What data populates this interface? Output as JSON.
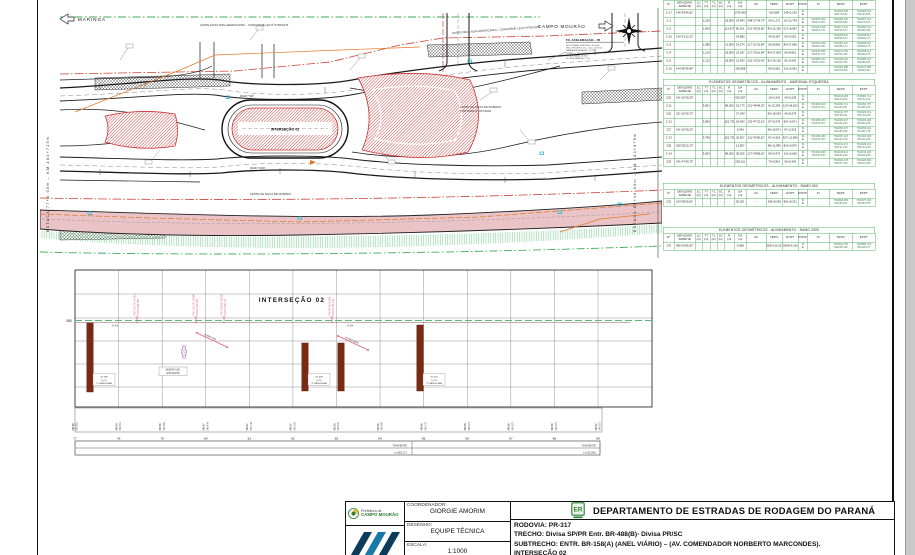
{
  "plan": {
    "dir_left": "MARINGÁ",
    "dir_right": "CAMPO MOURÃO",
    "intersection": "INTERSEÇÃO 02",
    "ramo_500": "RAMO \"500\"",
    "ramo_2000": "RAMO \"2000\"",
    "limite_nonaedificandi": "LIMITE FAIXA NON-AEDIFICANDI  –  CONFORME LEI Nº 6766/1979",
    "limite_dominio_1": "LIMITE DE FAIXA DE DOMÍNIO",
    "limite_dominio_2": "PORTARIA Nº 057/2018",
    "estaca_left": "ESTACA 77+0,00m   –   KM 183+725m",
    "estaca_right": "ESTACA 89+10,00m   –   KM 183+975m",
    "accel_title": "FX. ACELERAÇÃO – 05",
    "accel_lines": [
      "VELOCIDADE DIRETRIZ = 40 Km/h",
      "VEÍC. PROJETO: CO – Vop = 60 Km/h",
      "RAMPA ACELERAÇÃO = 0,75%",
      "COMPR. = 70 m  •  TAPER = 50 m",
      "FX. ADOTADA = 3,60 m",
      "FX. SEGURANÇA = 75 m"
    ]
  },
  "profile": {
    "title": "INTERSEÇÃO 02",
    "axis_elevation": "550",
    "stations": [
      "77",
      "78",
      "79",
      "80",
      "81",
      "82",
      "83",
      "84",
      "85",
      "86",
      "87",
      "88",
      "89"
    ],
    "elevations_design": [
      "549,88",
      "549,90",
      "549,86",
      "549,87",
      "549,87",
      "549,87",
      "549,85",
      "549,86",
      "549,86",
      "549,86",
      "549,86",
      "549,86",
      "549,87"
    ],
    "elevations_ground": [
      "549,851",
      "549,851",
      "549,869",
      "549,434",
      "549,144",
      "549,162",
      "549,320",
      "549,843",
      "549,770",
      "549,873",
      "549,872",
      "549,873",
      "549,872"
    ],
    "tangents": [
      {
        "t": "TANGENTE",
        "l": "L=158,171"
      },
      {
        "t": "TANGENTE",
        "l": "L=132,891"
      }
    ],
    "piv_labels": [
      {
        "a": "PIV=151.77+14,091",
        "b": "COTA=564,989"
      },
      {
        "a": "PIV=101.79+18,988",
        "b": "COTA=549,374"
      },
      {
        "a": "PIV=107.80+18,998",
        "b": "COTA=549,124"
      },
      {
        "a": "PIV=87.82+8,000",
        "b": "COTA=549,218"
      }
    ],
    "ramps": [
      "RAMO 500",
      "RAMO 2000"
    ],
    "markers": [
      "S–03",
      "S–04"
    ],
    "culvert": [
      "BUEIRO AÇO",
      "EXISTENTE"
    ],
    "boreholes": [
      {
        "label": "ST 008",
        "l": "L=1-0",
        "cat": "1ª CATEGORIA"
      },
      {
        "label": "ST 009",
        "l": "L=7-5",
        "cat": "1ª CATEGORIA"
      },
      {
        "label": "",
        "l": "",
        "cat": ""
      },
      {
        "label": "ST 010",
        "l": "L=7-5",
        "cat": "1ª CATEGORIA"
      }
    ]
  },
  "tables": {
    "columns": [
      "Nº",
      "DEFLEXÃO\nAZIMUTE",
      "LC\n(m)",
      "TT\n(m)",
      "TL\n(m)",
      "SC\n(m)",
      "R\n(m)",
      "DA\n(m)",
      "AC",
      "TE/PC",
      "ET/PT",
      "PONTO",
      "PI",
      "TE/PC",
      "ET/PT"
    ],
    "list": [
      {
        "title": "",
        "rows": [
          [
            "C-17",
            "146°53'46,61\"",
            "-",
            "-",
            "-",
            "-",
            "-",
            "1725,453",
            "-",
            "013,086",
            "140+1,253",
            "N\nE",
            "-",
            "7364094,483\n360176,824",
            "7364084,463\n360123,838"
          ],
          [
            "C-1",
            "-",
            "-",
            "1,225",
            "-",
            "-",
            "18,000",
            "24,694",
            "248°27'34,74\"",
            "09+1,272",
            "10+12,745",
            "N\nE",
            "7364045,809\n360321,955",
            "7364056,940\n360305,838",
            "7364057,101\n360276,815"
          ],
          [
            "C-2",
            "-",
            "-",
            "1,600",
            "-",
            "-",
            "113,675",
            "85,201",
            "212°36'18,80\"",
            "80+12,195",
            "017+8,587",
            "N\nE",
            "7364113,048\n360313,745",
            "7364117,341\n360310,572",
            "7364093,441\n360325,494"
          ],
          [
            "C-16",
            "140°13'12,23\"",
            "-",
            "-",
            "-",
            "-",
            "-",
            "24,880",
            "-",
            "43+8,287",
            "03+3,052",
            "N\nE",
            "-",
            "7364058,813\n360508,210",
            "7364058,901\n360508,273"
          ],
          [
            "C-3",
            "-",
            "-",
            "1,588",
            "-",
            "-",
            "13,000",
            "24,274",
            "217°21'26,84\"",
            "05+8,892",
            "84+17,895",
            "N\nE",
            "7364044,209\n360482,280",
            "7364054,407\n360488,272",
            "7364068,401\n360508,276"
          ],
          [
            "C-4",
            "-",
            "-",
            "1,116",
            "-",
            "-",
            "18,000",
            "23,187",
            "217°20'16,84\"",
            "84+17,803",
            "09+8,851",
            "N\nE",
            "7364046,868\n360336,778",
            "7364071,053\n360325,446",
            "7364055,413\n360308,278"
          ],
          [
            "C-5",
            "-",
            "-",
            "1,212",
            "-",
            "-",
            "18,000",
            "23,500",
            "215°10'22,40\"",
            "82+10,120",
            "91+3,642",
            "N\nE",
            "7364083,220\n360411,520",
            "7364090,118\n360402,335",
            "7364088,410\n360388,264"
          ],
          [
            "C-15",
            "144°50'36,84\"",
            "-",
            "-",
            "-",
            "-",
            "-",
            "190,088",
            "-",
            "80+5,851",
            "101+0,081",
            "N\nE",
            "-",
            "7364092,898\n360343,208",
            "7364101,988\n360308,403"
          ]
        ]
      },
      {
        "title": "ELEMENTOS GEOMÉTRICOS - ALINHAMENTO - MARGINAL ESQUERDA",
        "rows": [
          [
            "225",
            "241°18'18,33\"",
            "-",
            "-",
            "-",
            "-",
            "-",
            "602,287",
            "-",
            "10+1,941",
            "40+0,228",
            "N\nE",
            "-",
            "7364010,388\n360104,890",
            "7363982,714\n360700,202"
          ],
          [
            "C-11",
            "-",
            "-",
            "5,851",
            "-",
            "-",
            "88,000",
            "18,770",
            "212°48'48,32\"",
            "8+13,258",
            "120+18,812",
            "N\nE",
            "7364063,818\n361063,701",
            "7364064,714\n361064,787",
            "7364054,787\n361068,245"
          ],
          [
            "226",
            "221°18'18,72\"",
            "-",
            "-",
            "-",
            "-",
            "-",
            "27,043",
            "-",
            "83+18,034",
            "40+8,278",
            "N\nE",
            "-",
            "7364010,787\n360768,201",
            "7364029,001\n360748,228"
          ],
          [
            "C-12",
            "-",
            "-",
            "3,850",
            "-",
            "-",
            "162,735",
            "25,483",
            "232°47'22,41\"",
            "87+5,578",
            "587+5,871",
            "N\nE",
            "7364068,203\n361065,318",
            "7364066,407\n361062,025",
            "7364069,228\n361060,208"
          ],
          [
            "227",
            "241°18'18,32\"",
            "-",
            "-",
            "-",
            "-",
            "-",
            "5,940",
            "-",
            "96+15,871",
            "87+2,218",
            "N\nE",
            "-",
            "7364054,407\n361055,058",
            "7364056,410\n361056,728"
          ],
          [
            "C-13",
            "-",
            "-",
            "3,758",
            "-",
            "-",
            "162,735",
            "26,827",
            "211°43'58,62\"",
            "87+4,318",
            "627+11,895",
            "N\nE",
            "7364068,468\n361046,708",
            "7364067,103\n361044,728",
            "7364064,208\n361040,208"
          ],
          [
            "228",
            "208°28'22,23\"",
            "-",
            "-",
            "-",
            "-",
            "-",
            "13,807",
            "-",
            "98+11,985",
            "814+0,875",
            "N\nE",
            "-",
            "7364031,471\n360721,708",
            "7364029,013\n360720,228"
          ],
          [
            "C-14",
            "-",
            "-",
            "5,825",
            "-",
            "-",
            "88,000",
            "28,205",
            "217°49'58,42\"",
            "89+5,875",
            "101+5,818",
            "N\nE",
            "7364018,068\n360645,308",
            "7364018,414\n360642,028",
            "7364019,228\n360636,208"
          ],
          [
            "229",
            "241°47'49,73\"",
            "-",
            "-",
            "-",
            "-",
            "-",
            "230,011",
            "-",
            "70+5,810",
            "90+8,340",
            "N\nE",
            "-",
            "7364022,478\n360327,418",
            "7364029,828\n360312,028"
          ]
        ]
      },
      {
        "title": "ELEMENTOS GEOMÉTRICOS - ALINHAMENTO - RAMO 500",
        "rows": [
          [
            "232",
            "163°08'26,81\"",
            "-",
            "-",
            "-",
            "-",
            "-",
            "55,201",
            "-",
            "180+8,295",
            "802+8,201",
            "N\nE",
            "-",
            "7363928,089\n361083,231",
            "7363977,209\n361352,878"
          ]
        ]
      },
      {
        "title": "ELEMENTOS GEOMÉTRICOS - ALINHAMENTO - RAMO 2000",
        "rows": [
          [
            "270",
            "096°24'56,92\"",
            "-",
            "-",
            "-",
            "-",
            "-",
            "9,088",
            "-",
            "2824+12,012",
            "2904+0,010",
            "N\nE",
            "-",
            "7363814,785\n360318,448",
            "7363880,718\n360318,077"
          ]
        ]
      }
    ]
  },
  "title_block": {
    "coordenador_label": "COORDENADOR:",
    "coordenador": "GIORGIE AMORIM",
    "desenho_label": "DESENHO:",
    "desenho": "EQUIPE TÉCNICA",
    "escala_label": "ESCALA:",
    "escala": "1:1000",
    "department": "DEPARTAMENTO DE ESTRADAS DE RODAGEM DO PARANÁ",
    "rodovia": "RODOVIA: PR-317",
    "trecho": "TRECHO: Divisa SP/PR Entr. BR-488(B)- Divisa PR/SC",
    "subtrecho": "SUBTRECHO: ENTR. BR-158(A) (ANEL VIÁRIO) – (AV. COMENDADOR NORBERTO MARCONDES).",
    "line4": "INTERSEÇÃO 02",
    "city_logo_line1": "Prefeitura de",
    "city_logo_line2": "CAMPO MOURÃO",
    "der_logo_text": "ER"
  }
}
